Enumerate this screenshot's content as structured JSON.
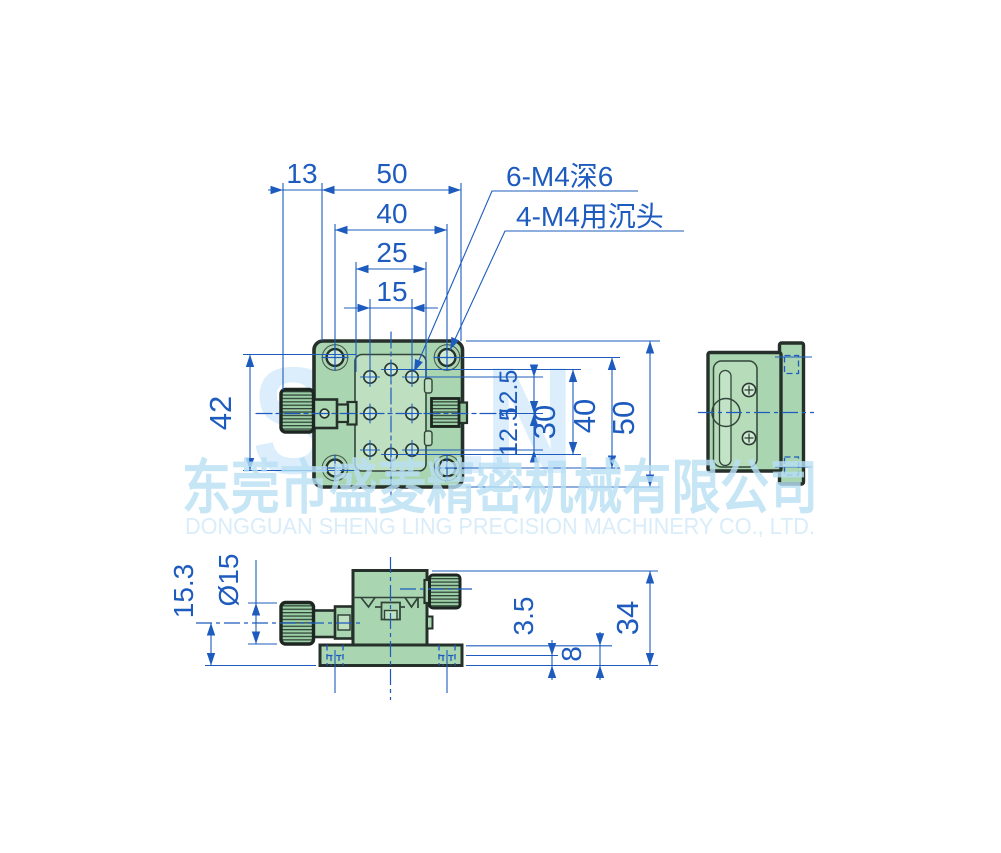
{
  "colors": {
    "body_green": "#a9d5b0",
    "plate_green": "#bedfc0",
    "outline_dark": "#25302a",
    "dimension_blue": "#1d5cbe",
    "watermark_light_blue": "#c3e3f6"
  },
  "watermark": {
    "brand": "SFLN",
    "company_cn": "东莞市盛菱精密机械有限公司",
    "company_en": "DONGGUAN SHENG LING PRECISION MACHINERY CO., LTD."
  },
  "notes": {
    "thread": "6-M4深6",
    "counterbore": "4-M4用沉头"
  },
  "dims": {
    "top": {
      "d13": "13",
      "d50": "50",
      "d40": "40",
      "d25": "25",
      "d15": "15",
      "d42": "42"
    },
    "right": {
      "d125a": "12.5",
      "d125b": "12.5",
      "d30": "30",
      "d40": "40",
      "d50": "50"
    },
    "front": {
      "d153": "15.3",
      "dia15": "Ø15",
      "d35": "3.5",
      "d8": "8",
      "d34": "34"
    }
  }
}
